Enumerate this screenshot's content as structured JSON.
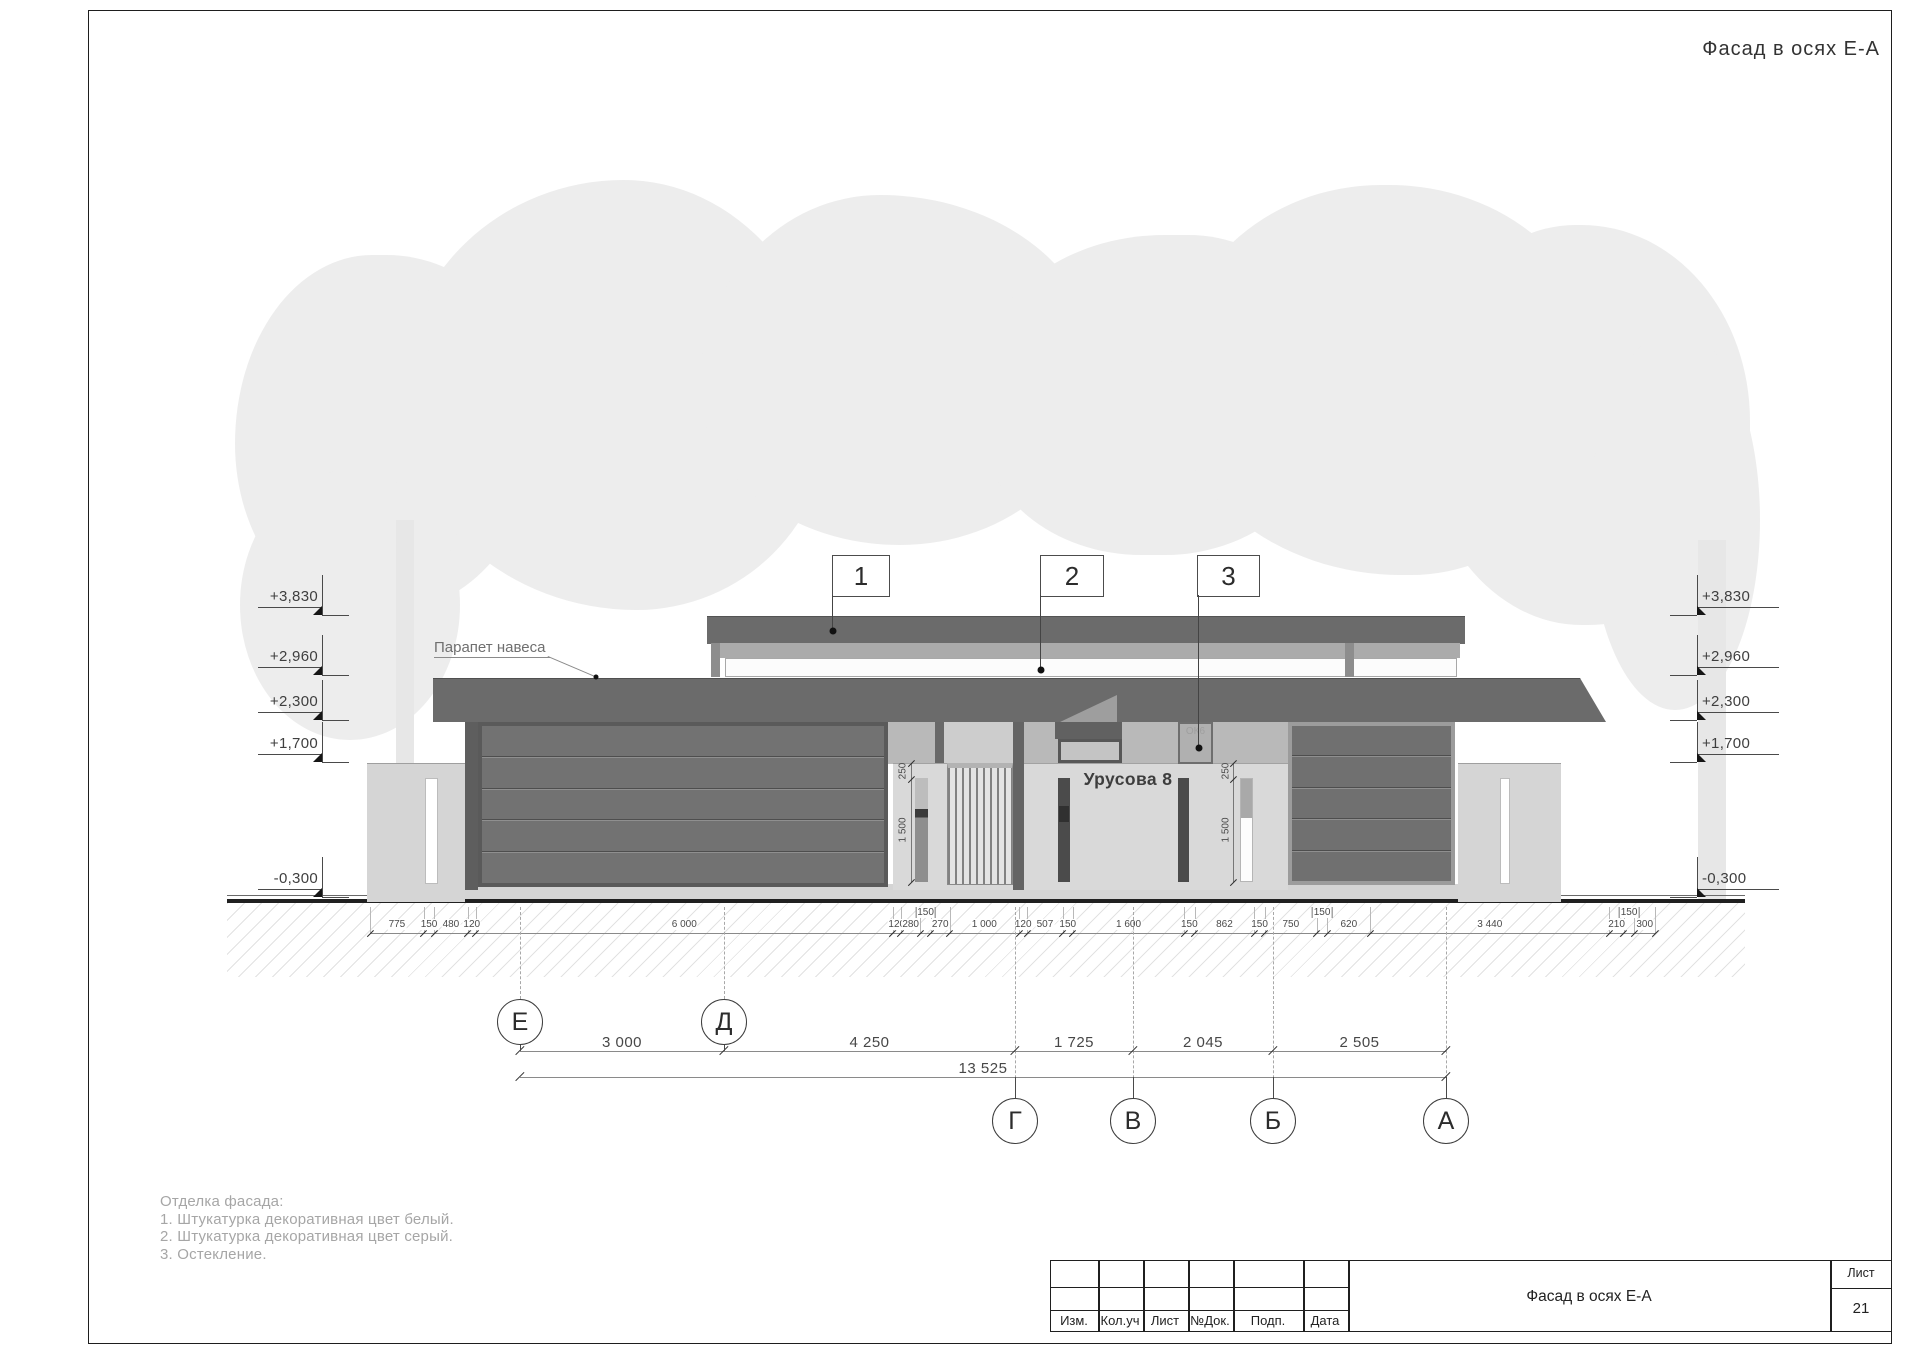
{
  "sheet": {
    "title_top": "Фасад в осях Е-А"
  },
  "elevation_marks": [
    "+3,830",
    "+2,960",
    "+2,300",
    "+1,700",
    "-0,300"
  ],
  "callouts": [
    "1",
    "2",
    "3"
  ],
  "labels": {
    "parapet": "Парапет навеса",
    "house_sign": "Урусова 8",
    "window": "ОК6"
  },
  "dims_small": [
    {
      "t": "775",
      "v": 775
    },
    {
      "t": "150",
      "v": 150
    },
    {
      "t": "480",
      "v": 480
    },
    {
      "t": "120",
      "v": 120
    },
    {
      "t": "6 000",
      "v": 6000
    },
    {
      "t": "120",
      "v": 120
    },
    {
      "t": "280",
      "v": 280
    },
    {
      "t": "150",
      "v": 150,
      "raised": true
    },
    {
      "t": "270",
      "v": 270
    },
    {
      "t": "1 000",
      "v": 1000
    },
    {
      "t": "120",
      "v": 120
    },
    {
      "t": "507",
      "v": 507
    },
    {
      "t": "150",
      "v": 150
    },
    {
      "t": "1 600",
      "v": 1600
    },
    {
      "t": "150",
      "v": 150
    },
    {
      "t": "862",
      "v": 862
    },
    {
      "t": "150",
      "v": 150
    },
    {
      "t": "750",
      "v": 750
    },
    {
      "t": "150",
      "v": 150,
      "raised": true
    },
    {
      "t": "620",
      "v": 620
    },
    {
      "t": "3 440",
      "v": 3440
    },
    {
      "t": "210",
      "v": 210
    },
    {
      "t": "150",
      "v": 150,
      "raised": true
    },
    {
      "t": "300",
      "v": 300
    }
  ],
  "dims_vertical": [
    "250",
    "1 500"
  ],
  "axes": {
    "labels": [
      "Е",
      "Д",
      "Г",
      "В",
      "Б",
      "А"
    ],
    "spans": [
      "3 000",
      "4 250",
      "1 725",
      "2 045",
      "2 505"
    ],
    "total": "13 525"
  },
  "notes": {
    "heading": "Отделка фасада:",
    "items": [
      "1. Штукатурка декоративная цвет белый.",
      "2. Штукатурка декоративная цвет серый.",
      "3. Остекление."
    ]
  },
  "title_block": {
    "columns": [
      "Изм.",
      "Кол.уч",
      "Лист",
      "№Док.",
      "Подп.",
      "Дата"
    ],
    "doc_title": "Фасад в осях Е-А",
    "sheet_label": "Лист",
    "sheet_number": "21"
  }
}
